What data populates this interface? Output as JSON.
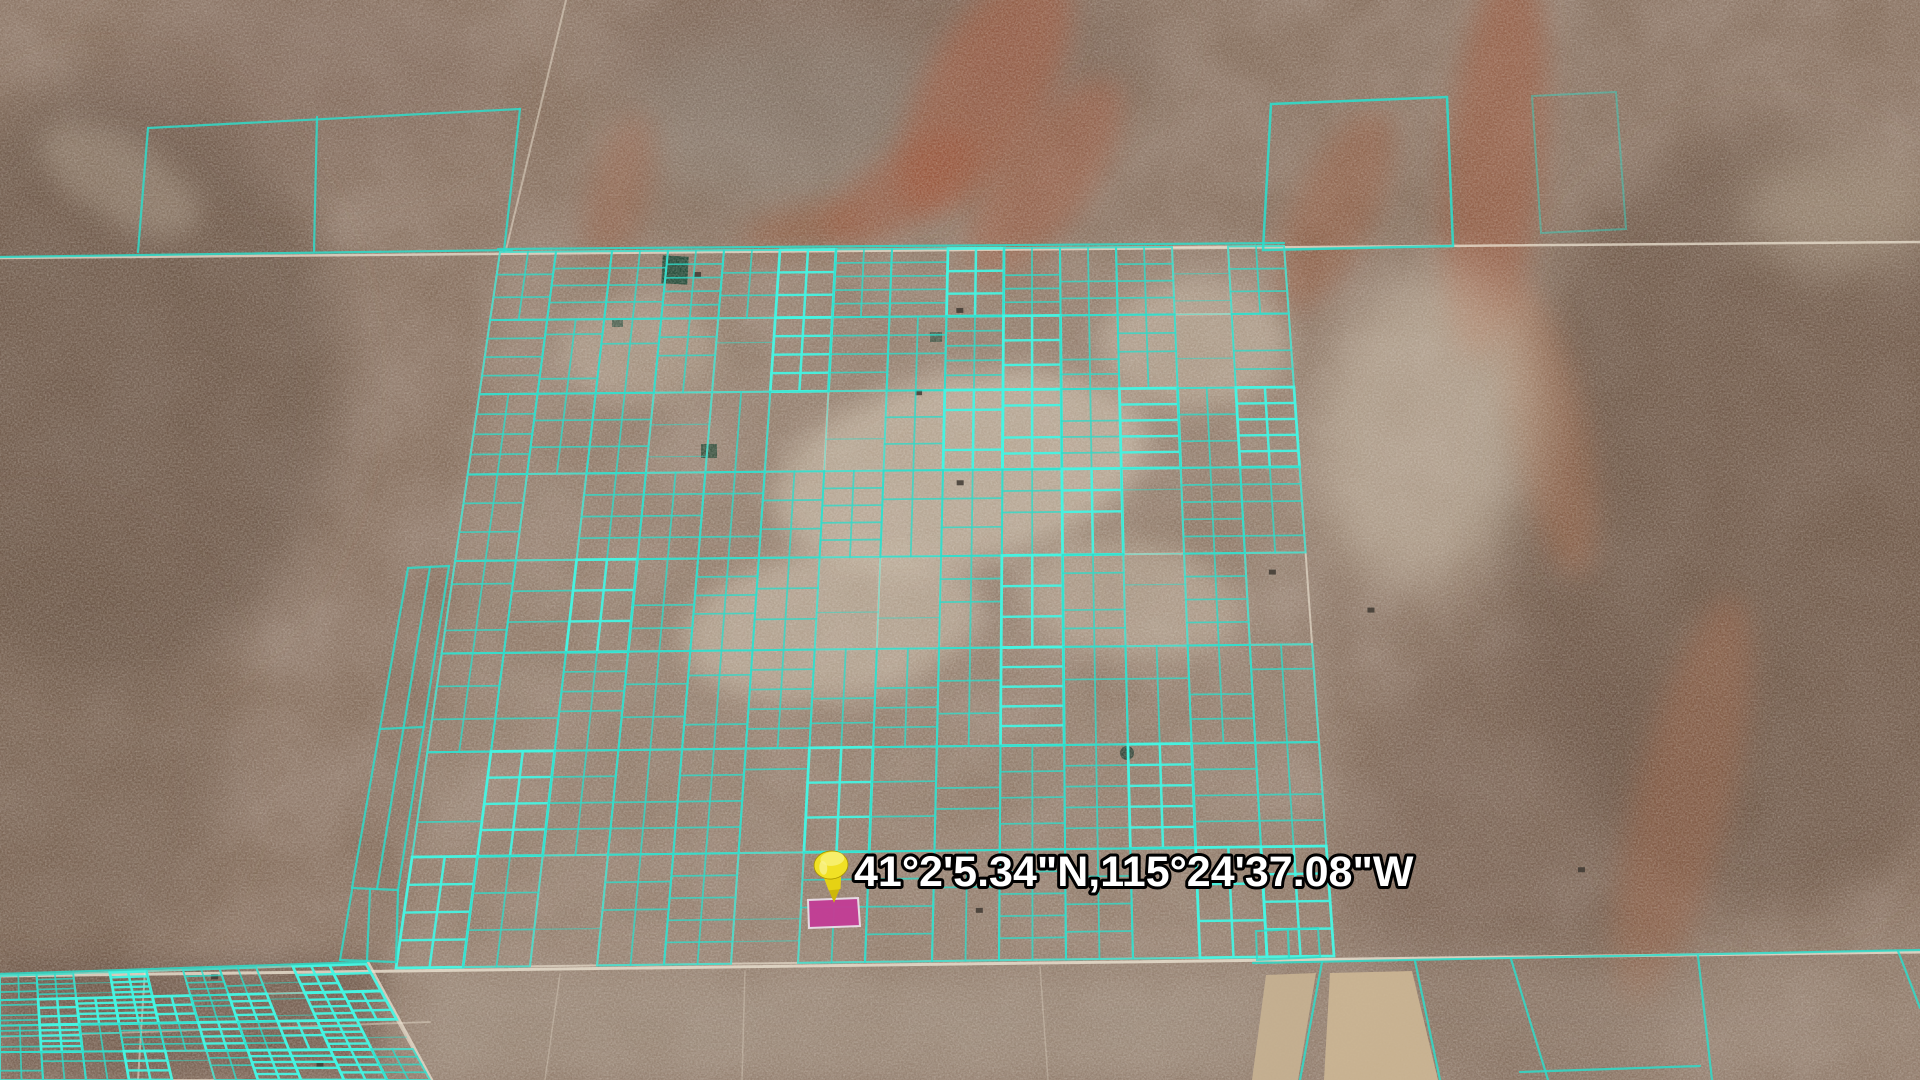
{
  "view": {
    "description": "Oblique satellite view of a desert valley with a subdivided land-parcel grid overlay",
    "width": 1920,
    "height": 1080
  },
  "placemark": {
    "label": "41°2'5.34\"N,115°24'37.08\"W",
    "label_fill": "#ffffff",
    "label_outline": "#000000",
    "label_font_size": 43,
    "label_x": 854,
    "label_y": 886,
    "pin_x": 833,
    "pin_y": 903,
    "pin_color": "#f1e125",
    "pin_shade": "#cdb70a",
    "pin_highlight": "#f9f28c"
  },
  "selected_parcel": {
    "points": "808,900 858,898 860,926 809,928",
    "fill": "#c23e95",
    "stroke": "#e9dde7"
  },
  "overlay": {
    "parcel_color": "#2edcca",
    "parcel_color_bright": "#45f4e2",
    "road_color": "#ece3d2",
    "house_color": "#3f3a32",
    "main_grid": {
      "tl": [
        500,
        252
      ],
      "tr": [
        1284,
        246
      ],
      "br": [
        1334,
        956
      ],
      "bl": [
        396,
        968
      ],
      "cols": 14,
      "rows": 8,
      "row_growth": 0.09,
      "seed": 13,
      "bright": 0.16
    },
    "bl_grid": {
      "tl": [
        0,
        976
      ],
      "tr": [
        366,
        964
      ],
      "br": [
        430,
        1080
      ],
      "bl": [
        0,
        1080
      ],
      "cols": 10,
      "rows": 4,
      "row_growth": 0.05,
      "seed": 5,
      "bright": 0.4
    },
    "static_lines": [
      [
        0,
        257,
        512,
        250
      ],
      [
        148,
        128,
        520,
        109
      ],
      [
        148,
        128,
        138,
        252
      ],
      [
        317,
        117,
        314,
        251
      ],
      [
        520,
        109,
        504,
        251
      ],
      [
        498,
        249,
        1284,
        243
      ],
      [
        0,
        974,
        366,
        962
      ],
      [
        408,
        568,
        449,
        566
      ],
      [
        408,
        568,
        352,
        888
      ],
      [
        449,
        566,
        398,
        890
      ],
      [
        352,
        888,
        398,
        890
      ],
      [
        380,
        729,
        424,
        727
      ],
      [
        430,
        567,
        377,
        889
      ],
      [
        352,
        890,
        340,
        960
      ],
      [
        398,
        890,
        396,
        962
      ],
      [
        340,
        960,
        396,
        962
      ],
      [
        370,
        890,
        367,
        961
      ],
      [
        1253,
        963,
        1920,
        950
      ],
      [
        1322,
        962,
        1300,
        1080
      ],
      [
        1415,
        961,
        1440,
        1080
      ],
      [
        1511,
        959,
        1548,
        1080
      ],
      [
        1698,
        956,
        1712,
        1080
      ],
      [
        1898,
        951,
        1920,
        1008
      ],
      [
        1520,
        1072,
        1700,
        1066
      ],
      [
        1288,
        930,
        1289,
        958
      ]
    ],
    "static_polys": [
      {
        "points": "1271,104 1447,97 1453,246 1263,250",
        "o": 0.9,
        "w": 2.5
      },
      {
        "points": "1532,96 1616,92 1626,229 1541,233",
        "o": 0.45,
        "w": 2
      },
      {
        "points": "1256,931 1318,928 1320,957 1257,960",
        "o": 0.8,
        "w": 2
      }
    ],
    "fields": [
      {
        "points": "1266,975 1316,973 1298,1080 1252,1080",
        "fill": "#c8b292"
      },
      {
        "points": "1330,973 1412,971 1438,1080 1324,1080",
        "fill": "#cdb795"
      }
    ],
    "roads": [
      [
        0,
        258,
        1920,
        242,
        2.5,
        0.75
      ],
      [
        0,
        976,
        1920,
        952,
        3,
        0.8
      ],
      [
        566,
        0,
        506,
        250,
        2,
        0.5
      ],
      [
        368,
        962,
        432,
        1080,
        2.5,
        0.75
      ],
      [
        560,
        974,
        545,
        1080,
        1.5,
        0.3
      ],
      [
        745,
        971,
        742,
        1080,
        1.5,
        0.3
      ],
      [
        1040,
        967,
        1048,
        1080,
        1.5,
        0.3
      ],
      [
        145,
        970,
        138,
        1080,
        2,
        0.55
      ],
      [
        0,
        1037,
        430,
        1022,
        1.8,
        0.45
      ]
    ]
  }
}
